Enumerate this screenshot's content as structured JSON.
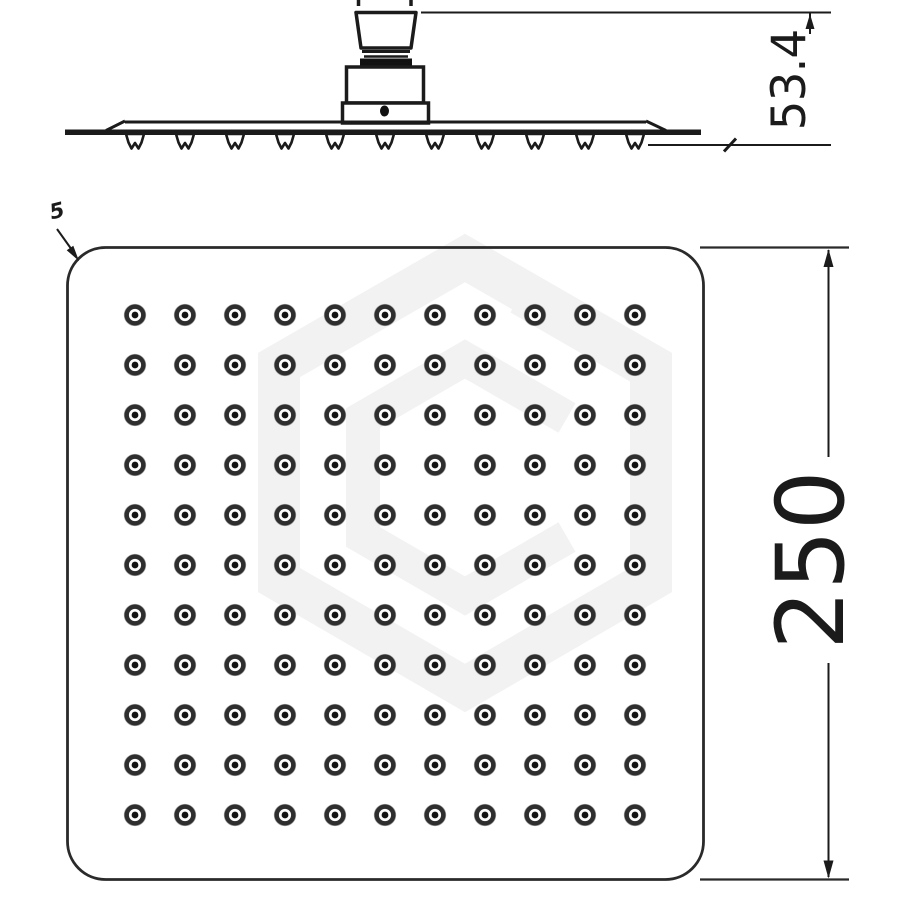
{
  "drawing": {
    "type": "technical-drawing-shower-head",
    "dimensions": {
      "height_label": "53.4",
      "width_label": "250",
      "corner_note": "5"
    },
    "side_view": {
      "nozzle_count": 11
    },
    "plan_view": {
      "nozzle_rows": 11,
      "nozzle_cols": 11
    },
    "colors": {
      "line": "#1b1b1b",
      "plan_outline": "#2a2a2a",
      "nozzle_dot_ring": "#2e2e2e",
      "nozzle_dot_center": "#141414",
      "watermark": "#f2f2f2",
      "background": "#ffffff"
    }
  }
}
